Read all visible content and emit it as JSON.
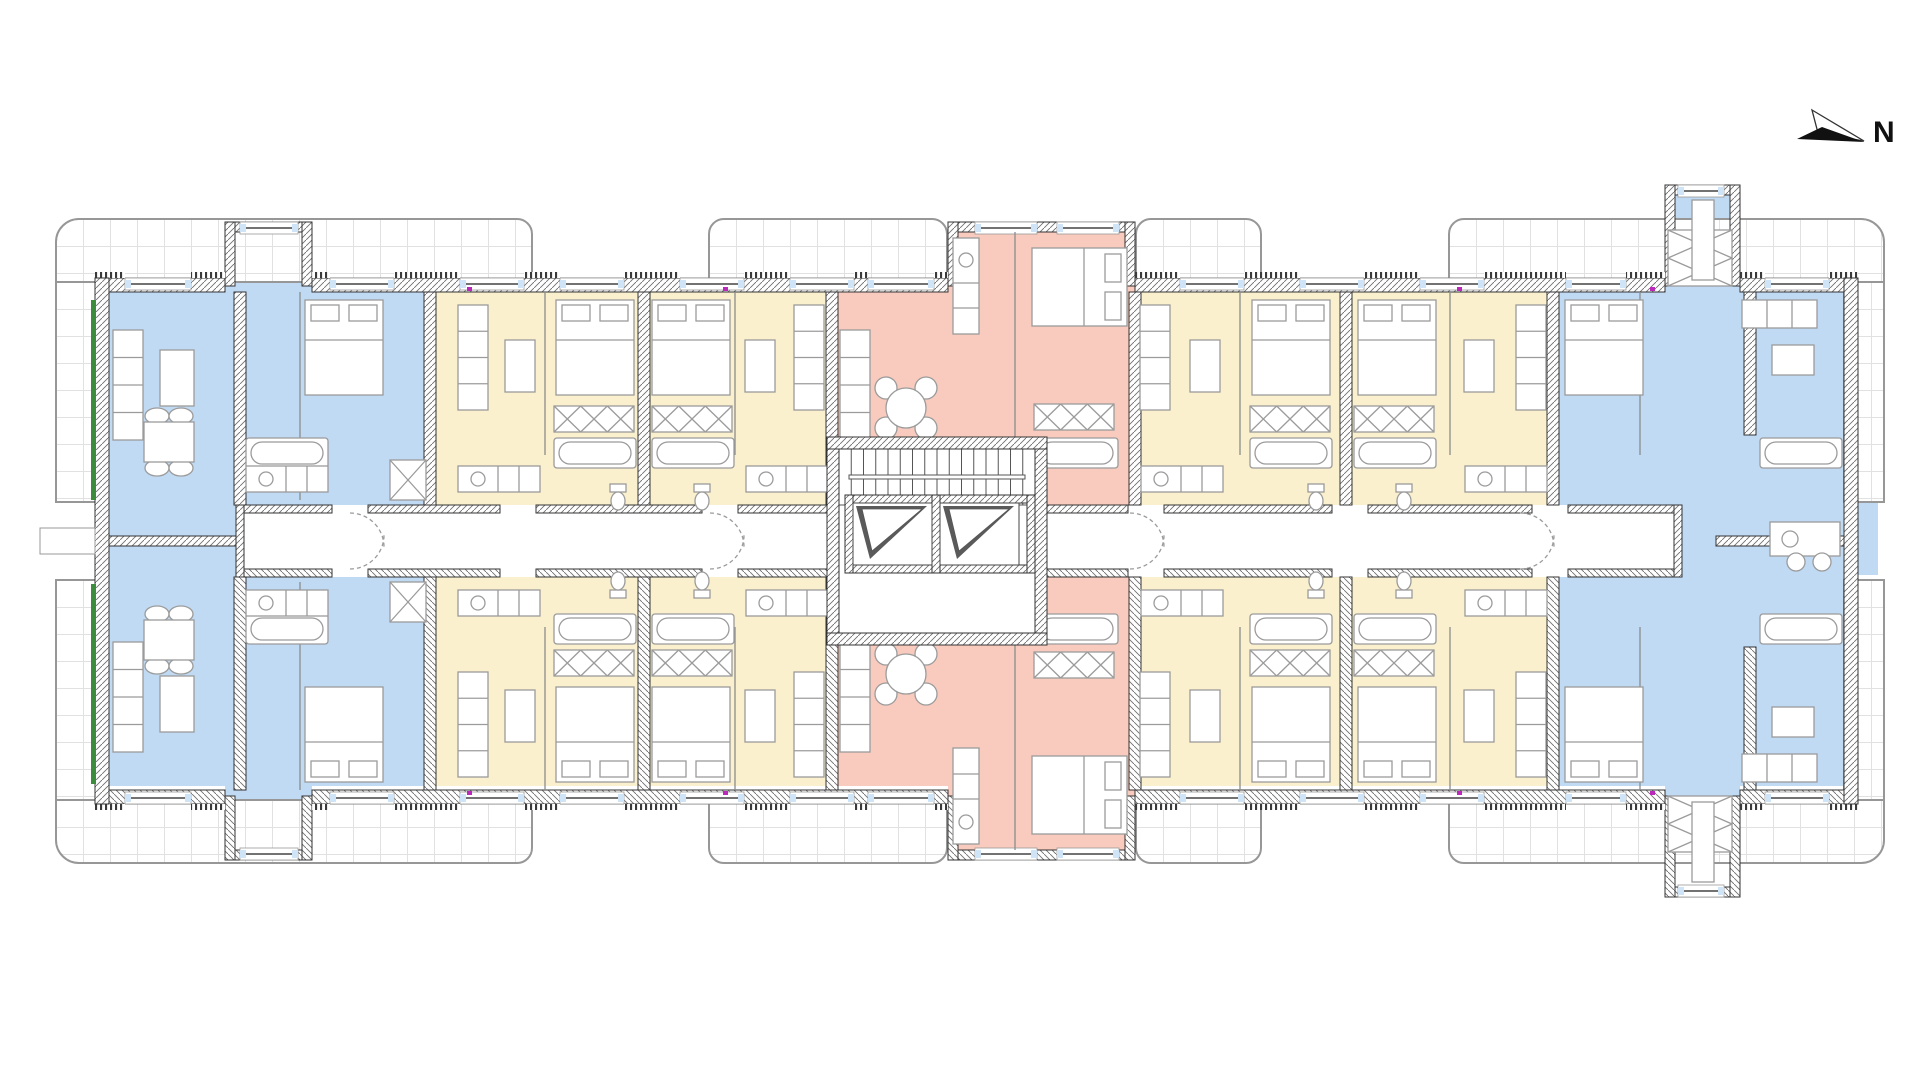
{
  "compass": {
    "label": "N"
  },
  "palette": {
    "unit_blue": "#c0daf3",
    "unit_yellow": "#faf0cd",
    "unit_pink": "#f9cbbe",
    "terrace_grid_line": "#e1e1e1",
    "terrace_border": "#979797",
    "wall_outline": "#333333",
    "hatch_line": "#6f6f6f",
    "furniture_line": "#9b9b9b",
    "partition_line": "#8c8c8c",
    "insulation_green": "#3d8b3d",
    "marker_magenta": "#bb29bb",
    "glazing_blue": "#cfe4f7"
  },
  "zones": [
    {
      "name": "unit-blue-left-column",
      "color": "unit_blue",
      "x": 109,
      "y": 292,
      "w": 131,
      "h": 494
    },
    {
      "name": "unit-blue-left-top",
      "color": "unit_blue",
      "x": 240,
      "y": 292,
      "w": 190,
      "h": 213
    },
    {
      "name": "unit-blue-left-bottom",
      "color": "unit_blue",
      "x": 240,
      "y": 577,
      "w": 190,
      "h": 209
    },
    {
      "name": "unit-blue-left-protrusion-top",
      "color": "unit_blue",
      "x": 225,
      "y": 228,
      "w": 87,
      "h": 64
    },
    {
      "name": "unit-blue-left-protrusion-bottom",
      "color": "unit_blue",
      "x": 225,
      "y": 786,
      "w": 87,
      "h": 66
    },
    {
      "name": "unit-yellow-left-top",
      "color": "unit_yellow",
      "x": 430,
      "y": 292,
      "w": 402,
      "h": 213
    },
    {
      "name": "unit-yellow-left-bottom",
      "color": "unit_yellow",
      "x": 430,
      "y": 577,
      "w": 402,
      "h": 209
    },
    {
      "name": "unit-pink-top",
      "color": "unit_pink",
      "x": 832,
      "y": 292,
      "w": 303,
      "h": 213
    },
    {
      "name": "unit-pink-bottom",
      "color": "unit_pink",
      "x": 832,
      "y": 577,
      "w": 303,
      "h": 209
    },
    {
      "name": "unit-pink-protrusion-top",
      "color": "unit_pink",
      "x": 948,
      "y": 228,
      "w": 187,
      "h": 64
    },
    {
      "name": "unit-pink-protrusion-bottom",
      "color": "unit_pink",
      "x": 948,
      "y": 786,
      "w": 187,
      "h": 66
    },
    {
      "name": "unit-yellow-right-top",
      "color": "unit_yellow",
      "x": 1135,
      "y": 292,
      "w": 418,
      "h": 213
    },
    {
      "name": "unit-yellow-right-bottom",
      "color": "unit_yellow",
      "x": 1135,
      "y": 577,
      "w": 418,
      "h": 209
    },
    {
      "name": "unit-blue-right-top",
      "color": "unit_blue",
      "x": 1553,
      "y": 292,
      "w": 291,
      "h": 213
    },
    {
      "name": "unit-blue-right-bottom",
      "color": "unit_blue",
      "x": 1553,
      "y": 577,
      "w": 291,
      "h": 209
    },
    {
      "name": "unit-blue-right-corridor-band",
      "color": "unit_blue",
      "x": 1682,
      "y": 505,
      "w": 162,
      "h": 72
    },
    {
      "name": "unit-blue-right-protrusion-top",
      "color": "unit_blue",
      "x": 1665,
      "y": 185,
      "w": 75,
      "h": 107
    },
    {
      "name": "unit-blue-right-protrusion-bottom",
      "color": "unit_blue",
      "x": 1665,
      "y": 786,
      "w": 75,
      "h": 70
    },
    {
      "name": "unit-blue-right-loggia",
      "color": "unit_blue",
      "x": 1858,
      "y": 430,
      "w": 20,
      "h": 145
    }
  ],
  "terraces": [
    {
      "name": "terrace-top-left",
      "x": 55,
      "y": 218,
      "w": 478,
      "h": 65,
      "r": [
        24,
        16,
        0,
        0
      ]
    },
    {
      "name": "terrace-left-upper",
      "x": 55,
      "y": 281,
      "w": 42,
      "h": 222,
      "r": [
        0,
        0,
        0,
        0
      ]
    },
    {
      "name": "terrace-top-mid-left",
      "x": 708,
      "y": 218,
      "w": 240,
      "h": 65,
      "r": [
        16,
        16,
        0,
        0
      ]
    },
    {
      "name": "terrace-top-mid-right",
      "x": 1135,
      "y": 218,
      "w": 127,
      "h": 65,
      "r": [
        16,
        16,
        0,
        0
      ]
    },
    {
      "name": "terrace-top-right",
      "x": 1448,
      "y": 218,
      "w": 437,
      "h": 65,
      "r": [
        16,
        24,
        0,
        0
      ]
    },
    {
      "name": "terrace-right-upper",
      "x": 1843,
      "y": 281,
      "w": 42,
      "h": 222,
      "r": [
        0,
        0,
        0,
        0
      ]
    },
    {
      "name": "terrace-bottom-left",
      "x": 55,
      "y": 799,
      "w": 478,
      "h": 65,
      "r": [
        0,
        0,
        16,
        24
      ]
    },
    {
      "name": "terrace-left-lower",
      "x": 55,
      "y": 579,
      "w": 42,
      "h": 222,
      "r": [
        0,
        0,
        0,
        0
      ]
    },
    {
      "name": "terrace-bottom-mid-left",
      "x": 708,
      "y": 799,
      "w": 240,
      "h": 65,
      "r": [
        0,
        0,
        16,
        16
      ]
    },
    {
      "name": "terrace-bottom-mid-right",
      "x": 1135,
      "y": 799,
      "w": 127,
      "h": 65,
      "r": [
        0,
        0,
        16,
        16
      ]
    },
    {
      "name": "terrace-bottom-right",
      "x": 1448,
      "y": 799,
      "w": 437,
      "h": 65,
      "r": [
        0,
        0,
        24,
        16
      ]
    },
    {
      "name": "terrace-right-lower",
      "x": 1843,
      "y": 579,
      "w": 42,
      "h": 222,
      "r": [
        0,
        0,
        0,
        0
      ]
    }
  ],
  "core": {
    "stair": {
      "x": 839,
      "y": 449,
      "w": 196,
      "h": 56,
      "treads": 15
    },
    "elevator_shafts": [
      {
        "x": 853,
        "y": 503,
        "w": 79,
        "h": 62
      },
      {
        "x": 940,
        "y": 503,
        "w": 79,
        "h": 62
      }
    ],
    "lobby": {
      "x": 839,
      "y": 577,
      "w": 196,
      "h": 56
    }
  }
}
